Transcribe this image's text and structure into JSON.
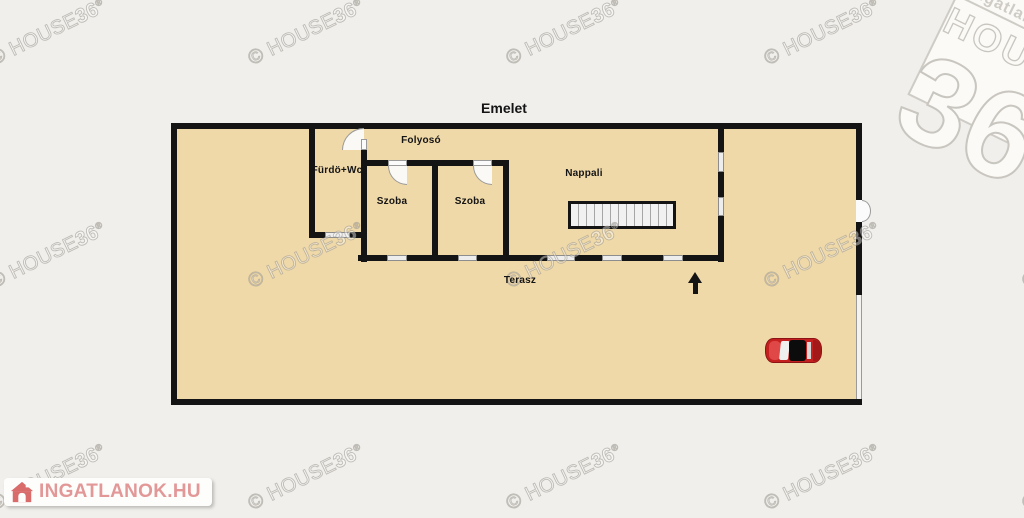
{
  "title": "Emelet",
  "rooms": {
    "hallway": "Folyosó",
    "bathroom": "Fürdö+Wc",
    "room1": "Szoba",
    "room2": "Szoba",
    "living": "Nappali",
    "terrace": "Terasz"
  },
  "watermark": {
    "prefix": "© HOUSE",
    "bold": "36",
    "reg": "®"
  },
  "logo_top": {
    "line1": "Ingatlanhálózat",
    "line2": "HOUSE",
    "line3": "36"
  },
  "logo_bottom": {
    "text": "INGATLANOK.HU"
  },
  "colors": {
    "background": "#f0efeb",
    "floor": "#f0d9a8",
    "wall": "#141414",
    "car_red": "#c42020",
    "logo_pink": "#e39898",
    "watermark_gray": "#d7d4cd"
  }
}
